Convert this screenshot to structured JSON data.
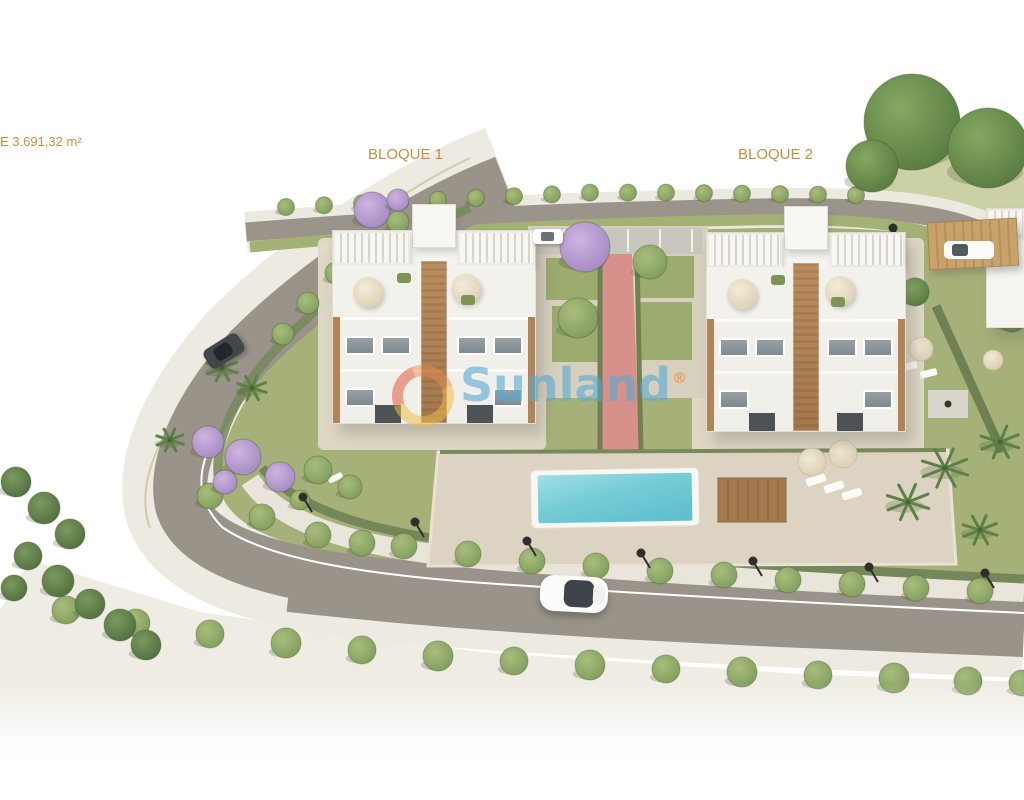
{
  "canvas": {
    "width": 1024,
    "height": 800,
    "background": "#ffffff"
  },
  "annotations": {
    "area_label": "E 3.691,32 m²",
    "block1_label": "BLOQUE 1",
    "block2_label": "BLOQUE 2",
    "label_color": "#c68f3f"
  },
  "watermark": {
    "brand": "Sunland",
    "registered_mark": "®",
    "text_color": "rgba(86,168,214,0.60)",
    "ring_color": "rgba(240,190,74,0.55)",
    "arc_color": "rgba(229,110,86,0.62)"
  },
  "scene_palette": {
    "road": "#99938a",
    "sidewalk": "#edeae1",
    "grass": "#a6b179",
    "pale_grass": "#cbd0a5",
    "hedge": "#6f8152",
    "pool_water": "#7dd0da",
    "pool_deck": "#ddd3c2",
    "path_pink": "#d8908b",
    "wood_deck": "#a57a4f",
    "building_white": "#f5f4f0",
    "jacaranda": "#b99dd1",
    "tree_green": "#84a15d",
    "pine_green": "#547241",
    "big_tree_green": "#67904c",
    "palm_green": "#5d8046",
    "car_white": "#fbfbfa",
    "lamp_black": "#2e2e2c"
  }
}
